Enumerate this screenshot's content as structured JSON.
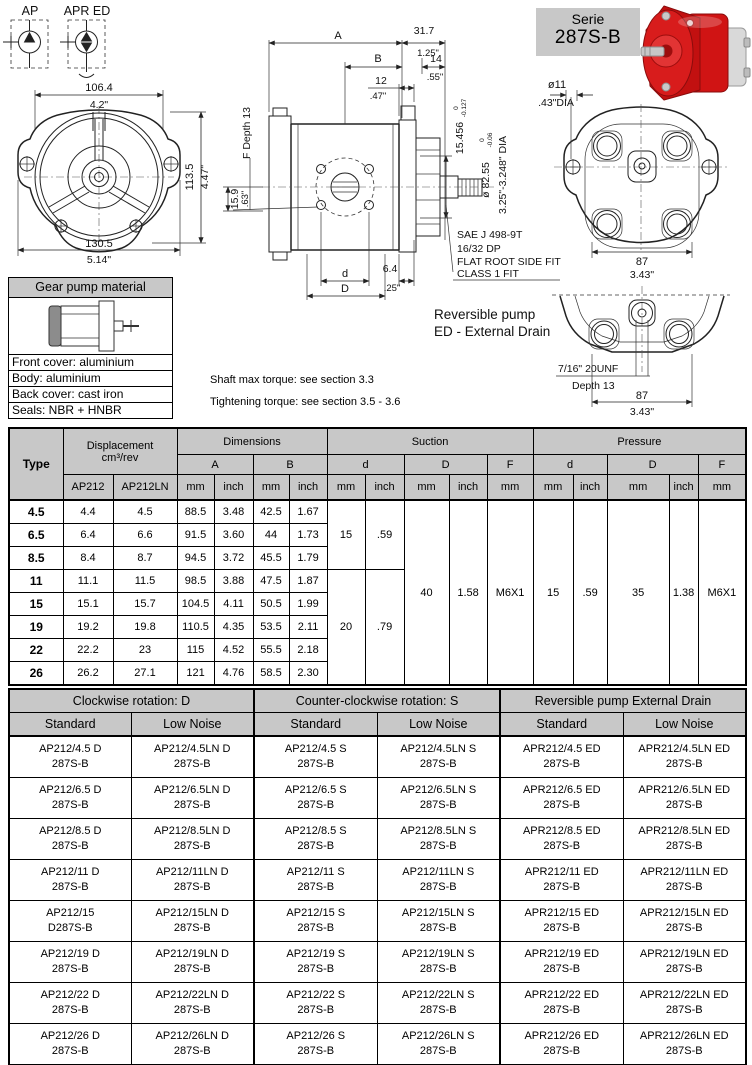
{
  "serie_box": {
    "line1": "Serie",
    "line2": "287S-B"
  },
  "symbols": {
    "ap": "AP",
    "apr_ed": "APR ED"
  },
  "front_view": {
    "top_mm": "106.4",
    "top_in": "4.2\"",
    "right_mm": "113.5",
    "right_in": "4.47\"",
    "bottom_mm": "130.5",
    "bottom_in": "5.14\""
  },
  "side_view": {
    "a": "A",
    "b": "B",
    "d12": "12",
    "d12_in": ".47\"",
    "d317": "31.7",
    "d317_in": "1.25\"",
    "d14": "14",
    "d14_in": ".55\"",
    "f_depth": "F Depth 13",
    "d159": "15.9",
    "d159_in": ".63\"",
    "d": "d",
    "D": "D",
    "d64": "6.4",
    "d64_in": ".25\"",
    "shaft_len": "15.456",
    "shaft_len_hi": "0",
    "shaft_len_lo": "-0.127",
    "shaft_dia": "ø 82.55",
    "shaft_dia_hi": "0",
    "shaft_dia_lo": "-0.06",
    "shaft_dia_in": "3.25\"-3.248\" DIA"
  },
  "notes": {
    "sae": [
      "SAE J 498-9T",
      "16/32 DP",
      "FLAT ROOT SIDE FIT",
      "CLASS 1 FIT"
    ],
    "reversible": [
      "Reversible pump",
      "ED - External Drain"
    ],
    "torque": [
      "Shaft max torque: see section 3.3",
      "Tightening torque: see section 3.5 - 3.6"
    ]
  },
  "rear_view": {
    "dia11": "ø11",
    "dia11_in": ".43\"DIA",
    "w_mm": "87",
    "w_in": "3.43\""
  },
  "rear_view2": {
    "thread": "7/16\" 20UNF",
    "depth": "Depth 13",
    "w_mm": "87",
    "w_in": "3.43\""
  },
  "material_box": {
    "title": "Gear pump material",
    "rows": [
      "Front cover: aluminium",
      "Body: aluminium",
      "Back cover: cast iron",
      "Seals: NBR + HNBR"
    ]
  },
  "table1": {
    "headers": {
      "type": "Type",
      "displacement": "Displacement",
      "displacement_unit": "cm³/rev",
      "ap212": "AP212",
      "ap212ln": "AP212LN",
      "dimensions": "Dimensions",
      "suction": "Suction",
      "pressure": "Pressure",
      "a": "A",
      "b": "B",
      "d_low": "d",
      "d_up": "D",
      "f": "F",
      "mm": "mm",
      "inch": "inch"
    },
    "rows": [
      {
        "type": "4.5",
        "ap212": "4.4",
        "ap212ln": "4.5",
        "a_mm": "88.5",
        "a_in": "3.48",
        "b_mm": "42.5",
        "b_in": "1.67"
      },
      {
        "type": "6.5",
        "ap212": "6.4",
        "ap212ln": "6.6",
        "a_mm": "91.5",
        "a_in": "3.60",
        "b_mm": "44",
        "b_in": "1.73"
      },
      {
        "type": "8.5",
        "ap212": "8.4",
        "ap212ln": "8.7",
        "a_mm": "94.5",
        "a_in": "3.72",
        "b_mm": "45.5",
        "b_in": "1.79"
      },
      {
        "type": "11",
        "ap212": "11.1",
        "ap212ln": "11.5",
        "a_mm": "98.5",
        "a_in": "3.88",
        "b_mm": "47.5",
        "b_in": "1.87"
      },
      {
        "type": "15",
        "ap212": "15.1",
        "ap212ln": "15.7",
        "a_mm": "104.5",
        "a_in": "4.11",
        "b_mm": "50.5",
        "b_in": "1.99"
      },
      {
        "type": "19",
        "ap212": "19.2",
        "ap212ln": "19.8",
        "a_mm": "110.5",
        "a_in": "4.35",
        "b_mm": "53.5",
        "b_in": "2.11"
      },
      {
        "type": "22",
        "ap212": "22.2",
        "ap212ln": "23",
        "a_mm": "115",
        "a_in": "4.52",
        "b_mm": "55.5",
        "b_in": "2.18"
      },
      {
        "type": "26",
        "ap212": "26.2",
        "ap212ln": "27.1",
        "a_mm": "121",
        "a_in": "4.76",
        "b_mm": "58.5",
        "b_in": "2.30"
      }
    ],
    "merged": {
      "suction_d_mm_a": "15",
      "suction_d_in_a": ".59",
      "suction_d_mm_b": "20",
      "suction_d_in_b": ".79",
      "suction_D_mm": "40",
      "suction_D_in": "1.58",
      "suction_F": "M6X1",
      "pressure_d_mm": "15",
      "pressure_d_in": ".59",
      "pressure_D_mm": "35",
      "pressure_D_in": "1.38",
      "pressure_F": "M6X1"
    }
  },
  "table2": {
    "groups": [
      "Clockwise rotation: D",
      "Counter-clockwise rotation: S",
      "Reversible pump External Drain"
    ],
    "subheaders": [
      "Standard",
      "Low Noise"
    ],
    "rows": [
      [
        [
          "AP212/4.5 D",
          "287S-B"
        ],
        [
          "AP212/4.5LN D",
          "287S-B"
        ],
        [
          "AP212/4.5 S",
          "287S-B"
        ],
        [
          "AP212/4.5LN S",
          "287S-B"
        ],
        [
          "APR212/4.5 ED",
          "287S-B"
        ],
        [
          "APR212/4.5LN ED",
          "287S-B"
        ]
      ],
      [
        [
          "AP212/6.5 D",
          "287S-B"
        ],
        [
          "AP212/6.5LN D",
          "287S-B"
        ],
        [
          "AP212/6.5 S",
          "287S-B"
        ],
        [
          "AP212/6.5LN S",
          "287S-B"
        ],
        [
          "APR212/6.5 ED",
          "287S-B"
        ],
        [
          "APR212/6.5LN ED",
          "287S-B"
        ]
      ],
      [
        [
          "AP212/8.5 D",
          "287S-B"
        ],
        [
          "AP212/8.5LN D",
          "287S-B"
        ],
        [
          "AP212/8.5 S",
          "287S-B"
        ],
        [
          "AP212/8.5LN S",
          "287S-B"
        ],
        [
          "APR212/8.5 ED",
          "287S-B"
        ],
        [
          "APR212/8.5LN ED",
          "287S-B"
        ]
      ],
      [
        [
          "AP212/11 D",
          "287S-B"
        ],
        [
          "AP212/11LN D",
          "287S-B"
        ],
        [
          "AP212/11 S",
          "287S-B"
        ],
        [
          "AP212/11LN S",
          "287S-B"
        ],
        [
          "APR212/11 ED",
          "287S-B"
        ],
        [
          "APR212/11LN ED",
          "287S-B"
        ]
      ],
      [
        [
          "AP212/15",
          "D287S-B"
        ],
        [
          "AP212/15LN D",
          "287S-B"
        ],
        [
          "AP212/15 S",
          "287S-B"
        ],
        [
          "AP212/15LN S",
          "287S-B"
        ],
        [
          "APR212/15 ED",
          "287S-B"
        ],
        [
          "APR212/15LN ED",
          "287S-B"
        ]
      ],
      [
        [
          "AP212/19 D",
          "287S-B"
        ],
        [
          "AP212/19LN D",
          "287S-B"
        ],
        [
          "AP212/19 S",
          "287S-B"
        ],
        [
          "AP212/19LN S",
          "287S-B"
        ],
        [
          "APR212/19 ED",
          "287S-B"
        ],
        [
          "APR212/19LN ED",
          "287S-B"
        ]
      ],
      [
        [
          "AP212/22 D",
          "287S-B"
        ],
        [
          "AP212/22LN D",
          "287S-B"
        ],
        [
          "AP212/22 S",
          "287S-B"
        ],
        [
          "AP212/22LN S",
          "287S-B"
        ],
        [
          "APR212/22 ED",
          "287S-B"
        ],
        [
          "APR212/22LN ED",
          "287S-B"
        ]
      ],
      [
        [
          "AP212/26 D",
          "287S-B"
        ],
        [
          "AP212/26LN D",
          "287S-B"
        ],
        [
          "AP212/26 S",
          "287S-B"
        ],
        [
          "AP212/26LN S",
          "287S-B"
        ],
        [
          "APR212/26 ED",
          "287S-B"
        ],
        [
          "APR212/26LN ED",
          "287S-B"
        ]
      ]
    ]
  },
  "colors": {
    "header_gray": "#c8c8c8",
    "pump_red": "#d01414"
  }
}
